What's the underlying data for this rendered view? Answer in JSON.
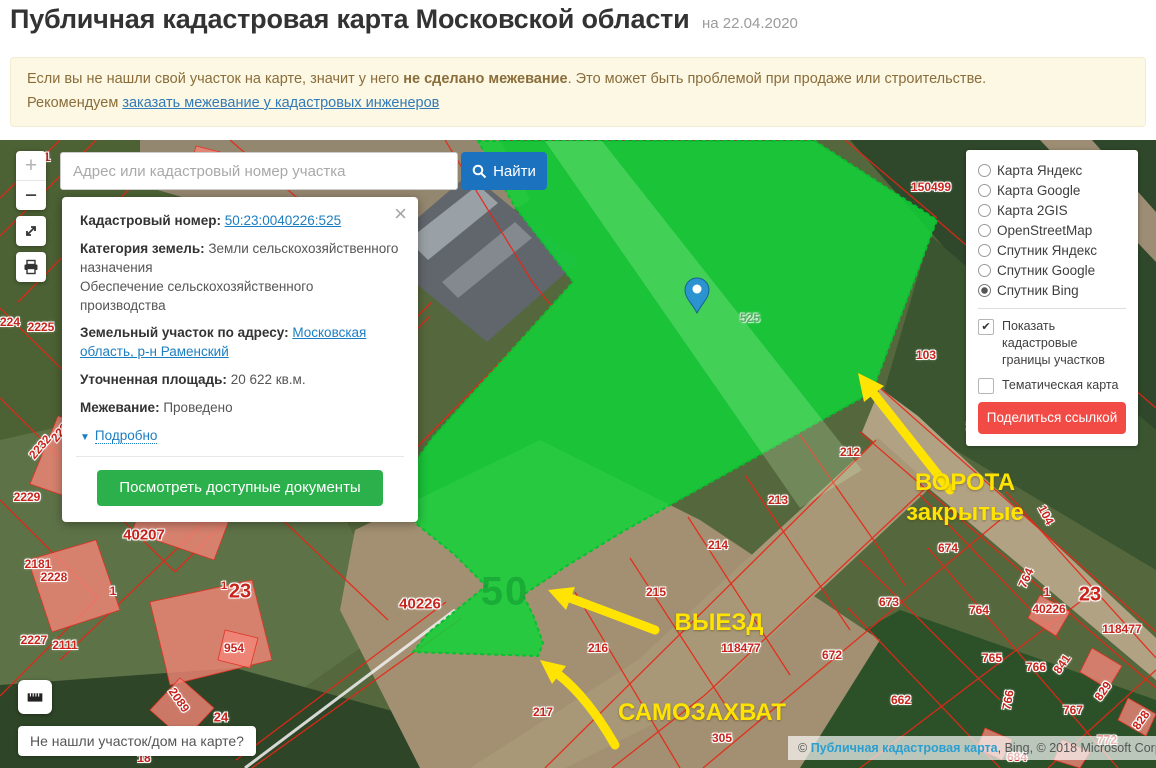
{
  "header": {
    "title": "Публичная кадастровая карта Московской области",
    "date": "на 22.04.2020"
  },
  "notice": {
    "line1_pre": "Если вы не нашли свой участок на карте, значит у него ",
    "line1_bold": "не сделано межевание",
    "line1_post": ". Это может быть проблемой при продаже или строительстве.",
    "line2_pre": "Рекомендуем ",
    "line2_link": "заказать межевание у кадастровых инженеров"
  },
  "search": {
    "placeholder": "Адрес или кадастровый номер участка",
    "button": "Найти"
  },
  "controls": {
    "zoom_in": "+",
    "zoom_out": "−"
  },
  "popup": {
    "close": "×",
    "cadastral_label": "Кадастровый номер:",
    "cadastral_value": "50:23:0040226:525",
    "category_label": "Категория земель:",
    "category_value": "Земли сельскохозяйственного назначения",
    "category_extra": "Обеспечение сельскохозяйственного производства",
    "address_label": "Земельный участок по адресу:",
    "address_value": "Московская область, р-н Раменский",
    "area_label": "Уточненная площадь:",
    "area_value": "20 622 кв.м.",
    "survey_label": "Межевание:",
    "survey_value": "Проведено",
    "details_caret": "▼",
    "details_link": "Подробно",
    "documents_button": "Посмотреть доступные документы"
  },
  "layers": {
    "options": [
      {
        "label": "Карта Яндекс",
        "selected": false
      },
      {
        "label": "Карта Google",
        "selected": false
      },
      {
        "label": "Карта 2GIS",
        "selected": false
      },
      {
        "label": "OpenStreetMap",
        "selected": false
      },
      {
        "label": "Спутник Яндекс",
        "selected": false
      },
      {
        "label": "Спутник Google",
        "selected": false
      },
      {
        "label": "Спутник Bing",
        "selected": true
      }
    ],
    "borders_label": "Показать кадастровые границы участков",
    "borders_checked": true,
    "thematic_label": "Тематическая карта",
    "thematic_checked": false,
    "share_button": "Поделиться ссылкой"
  },
  "annotations": {
    "gate1": "ВОРОТА",
    "gate2": "закрытые",
    "exit": "ВЫЕЗД",
    "squat": "САМОЗАХВАТ"
  },
  "map": {
    "selected_parcel_watermark": "50",
    "parcel_labels": [
      {
        "t": "1",
        "x": 47,
        "y": 17
      },
      {
        "t": "224",
        "x": 10,
        "y": 182
      },
      {
        "t": "2225",
        "x": 41,
        "y": 187
      },
      {
        "t": "2232",
        "x": 40,
        "y": 307,
        "r": -50
      },
      {
        "t": "2237",
        "x": 62,
        "y": 290,
        "r": -50
      },
      {
        "t": "2187",
        "x": 106,
        "y": 322
      },
      {
        "t": "2233",
        "x": 104,
        "y": 338
      },
      {
        "t": "2229",
        "x": 27,
        "y": 357
      },
      {
        "t": "40207",
        "x": 144,
        "y": 395,
        "s": 15
      },
      {
        "t": "2181",
        "x": 38,
        "y": 424
      },
      {
        "t": "2228",
        "x": 54,
        "y": 437
      },
      {
        "t": "1",
        "x": 113,
        "y": 451
      },
      {
        "t": "1",
        "x": 224,
        "y": 446,
        "s": 11
      },
      {
        "t": "23",
        "x": 240,
        "y": 452,
        "s": 20
      },
      {
        "t": "954",
        "x": 234,
        "y": 508
      },
      {
        "t": "2227",
        "x": 34,
        "y": 500
      },
      {
        "t": "2111",
        "x": 65,
        "y": 505
      },
      {
        "t": "2089",
        "x": 179,
        "y": 560,
        "r": 55
      },
      {
        "t": "24",
        "x": 221,
        "y": 577,
        "s": 13
      },
      {
        "t": "18",
        "x": 144,
        "y": 618
      },
      {
        "t": "525",
        "x": 750,
        "y": 178,
        "c": "green"
      },
      {
        "t": "50",
        "x": 505,
        "y": 452,
        "c": "wm"
      },
      {
        "t": "150499",
        "x": 931,
        "y": 47
      },
      {
        "t": "103",
        "x": 926,
        "y": 215
      },
      {
        "t": "104",
        "x": 976,
        "y": 286
      },
      {
        "t": "104",
        "x": 1046,
        "y": 375,
        "r": 62
      },
      {
        "t": "212",
        "x": 850,
        "y": 312
      },
      {
        "t": "213",
        "x": 778,
        "y": 360
      },
      {
        "t": "214",
        "x": 718,
        "y": 405
      },
      {
        "t": "215",
        "x": 656,
        "y": 452
      },
      {
        "t": "216",
        "x": 598,
        "y": 508
      },
      {
        "t": "217",
        "x": 543,
        "y": 572
      },
      {
        "t": "40226",
        "x": 420,
        "y": 464,
        "s": 15
      },
      {
        "t": "118477",
        "x": 741,
        "y": 508
      },
      {
        "t": "305",
        "x": 722,
        "y": 598
      },
      {
        "t": "674",
        "x": 948,
        "y": 408
      },
      {
        "t": "673",
        "x": 889,
        "y": 462
      },
      {
        "t": "672",
        "x": 832,
        "y": 515
      },
      {
        "t": "662",
        "x": 901,
        "y": 560
      },
      {
        "t": "764",
        "x": 1026,
        "y": 438,
        "r": -65
      },
      {
        "t": "764",
        "x": 979,
        "y": 470
      },
      {
        "t": "1",
        "x": 1047,
        "y": 452
      },
      {
        "t": "40226",
        "x": 1049,
        "y": 469
      },
      {
        "t": "23",
        "x": 1090,
        "y": 455,
        "s": 20
      },
      {
        "t": "118477",
        "x": 1122,
        "y": 489
      },
      {
        "t": "765",
        "x": 992,
        "y": 518
      },
      {
        "t": "766",
        "x": 1036,
        "y": 527
      },
      {
        "t": "841",
        "x": 1062,
        "y": 524,
        "r": -55
      },
      {
        "t": "766",
        "x": 1008,
        "y": 560,
        "r": -80
      },
      {
        "t": "767",
        "x": 1073,
        "y": 570
      },
      {
        "t": "829",
        "x": 1103,
        "y": 551,
        "r": -55
      },
      {
        "t": "828",
        "x": 1141,
        "y": 580,
        "r": -55
      },
      {
        "t": "772",
        "x": 1107,
        "y": 600
      },
      {
        "t": "684",
        "x": 1017,
        "y": 617
      }
    ]
  },
  "bottom": {
    "not_found": "Не нашли участок/дом на карте?",
    "attr_pre": "© ",
    "attr_link": "Публичная кадастровая карта",
    "attr_post": ", Bing, © 2018 Microsoft Corporation"
  },
  "colors": {
    "find_button": "#1b72be",
    "documents_button": "#2cb04b",
    "share_button": "#f24b45",
    "selected_parcel": "#10d437",
    "annotation_yellow": "#ffe403",
    "parcel_number_red": "#c8241c",
    "notice_bg": "#fcf8e3"
  }
}
